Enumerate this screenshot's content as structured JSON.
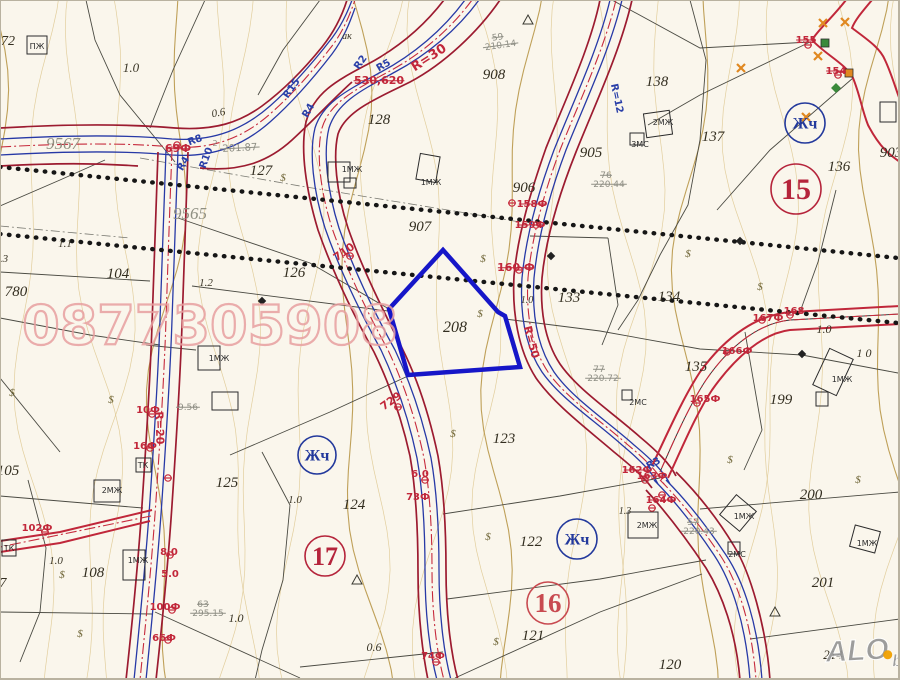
{
  "map": {
    "title": "cadastral-plan-scan",
    "colors": {
      "background": "#faf6ec",
      "road_red": "#9c1b30",
      "road_center_red": "#c62a3c",
      "line_blue": "#2739a6",
      "contour_light": "#dcc489",
      "contour_dark": "#b4903e",
      "parcel_line": "#4a4a42",
      "dotted_black": "#161616",
      "polygon_blue": "#1616c8",
      "watermark_pink": "#e8a0a0",
      "circle_red": "#b5243b",
      "circle_blue": "#23399c",
      "logo_gray": "#969696",
      "logo_orange": "#f0a000",
      "symbol_olive": "#6a6030",
      "marker_orange": "#e08820",
      "marker_green": "#3a8a3a"
    },
    "watermark": {
      "text": "0877305908",
      "x": 210,
      "y": 344,
      "size": 54
    },
    "logo": {
      "main": "ALO",
      "sub": "bg",
      "x": 826,
      "y": 662
    },
    "subject_parcel": {
      "number": "208",
      "points": "443,250 498,312 505,316 520,367 408,375 389,309"
    },
    "circled_labels": [
      {
        "t": "15",
        "x": 796,
        "y": 189,
        "r": 25,
        "c": "#b5243b",
        "fs": 30
      },
      {
        "t": "17",
        "x": 325,
        "y": 556,
        "r": 20,
        "c": "#b5243b",
        "fs": 26
      },
      {
        "t": "16",
        "x": 548,
        "y": 603,
        "r": 21,
        "c": "#c84a50",
        "fs": 27
      },
      {
        "t": "Жч",
        "x": 805,
        "y": 123,
        "r": 20,
        "c": "#23399c",
        "fs": 16
      },
      {
        "t": "Жч",
        "x": 317,
        "y": 455,
        "r": 19,
        "c": "#23399c",
        "fs": 16
      },
      {
        "t": "Жч",
        "x": 577,
        "y": 539,
        "r": 20,
        "c": "#23399c",
        "fs": 16
      }
    ],
    "labels": [
      {
        "t": "72",
        "x": 8,
        "y": 45,
        "c": "parcel",
        "s": 14
      },
      {
        "t": "127",
        "x": 261,
        "y": 175,
        "c": "parcel",
        "s": 15
      },
      {
        "t": "128",
        "x": 379,
        "y": 124,
        "c": "parcel",
        "s": 15
      },
      {
        "t": "908",
        "x": 494,
        "y": 79,
        "c": "parcel",
        "s": 15
      },
      {
        "t": "905",
        "x": 591,
        "y": 157,
        "c": "parcel",
        "s": 15
      },
      {
        "t": "906",
        "x": 524,
        "y": 192,
        "c": "parcel",
        "s": 15
      },
      {
        "t": "907",
        "x": 420,
        "y": 231,
        "c": "parcel",
        "s": 15
      },
      {
        "t": "903",
        "x": 891,
        "y": 157,
        "c": "parcel",
        "s": 15
      },
      {
        "t": "138",
        "x": 657,
        "y": 86,
        "c": "parcel",
        "s": 15
      },
      {
        "t": "137",
        "x": 713,
        "y": 141,
        "c": "parcel",
        "s": 15
      },
      {
        "t": "136",
        "x": 839,
        "y": 171,
        "c": "parcel",
        "s": 15
      },
      {
        "t": "104",
        "x": 118,
        "y": 278,
        "c": "parcel",
        "s": 15
      },
      {
        "t": "780",
        "x": 16,
        "y": 296,
        "c": "parcel",
        "s": 15
      },
      {
        "t": "126",
        "x": 294,
        "y": 277,
        "c": "parcel",
        "s": 15
      },
      {
        "t": "133",
        "x": 569,
        "y": 302,
        "c": "parcel",
        "s": 15
      },
      {
        "t": "134",
        "x": 669,
        "y": 301,
        "c": "parcel",
        "s": 15
      },
      {
        "t": "135",
        "x": 696,
        "y": 371,
        "c": "parcel",
        "s": 15
      },
      {
        "t": "199",
        "x": 781,
        "y": 404,
        "c": "parcel",
        "s": 15
      },
      {
        "t": "208",
        "x": 455,
        "y": 332,
        "c": "parcel",
        "s": 16
      },
      {
        "t": "123",
        "x": 504,
        "y": 443,
        "c": "parcel",
        "s": 15
      },
      {
        "t": "125",
        "x": 227,
        "y": 487,
        "c": "parcel",
        "s": 15
      },
      {
        "t": "124",
        "x": 354,
        "y": 509,
        "c": "parcel",
        "s": 15
      },
      {
        "t": "122",
        "x": 531,
        "y": 546,
        "c": "parcel",
        "s": 15
      },
      {
        "t": "121",
        "x": 533,
        "y": 640,
        "c": "parcel",
        "s": 15
      },
      {
        "t": "105",
        "x": 8,
        "y": 475,
        "c": "parcel",
        "s": 15
      },
      {
        "t": "108",
        "x": 93,
        "y": 577,
        "c": "parcel",
        "s": 15
      },
      {
        "t": "7",
        "x": 3,
        "y": 587,
        "c": "parcel",
        "s": 14
      },
      {
        "t": "120",
        "x": 670,
        "y": 669,
        "c": "parcel",
        "s": 15
      },
      {
        "t": "200",
        "x": 811,
        "y": 499,
        "c": "parcel",
        "s": 15
      },
      {
        "t": "201",
        "x": 823,
        "y": 587,
        "c": "parcel",
        "s": 15
      },
      {
        "t": "214",
        "x": 833,
        "y": 659,
        "c": "parcel",
        "s": 13
      },
      {
        "t": "9567",
        "x": 63,
        "y": 149,
        "c": "street",
        "s": 17
      },
      {
        "t": "9565",
        "x": 190,
        "y": 219,
        "c": "street",
        "s": 17
      },
      {
        "t": "1.0",
        "x": 131,
        "y": 72,
        "c": "small",
        "s": 13
      },
      {
        "t": "0.6",
        "x": 219,
        "y": 116,
        "c": "small",
        "s": 11,
        "r": -10
      },
      {
        "t": "ак",
        "x": 347,
        "y": 39,
        "c": "small",
        "s": 10
      },
      {
        "t": "1.1",
        "x": 65,
        "y": 247,
        "c": "small",
        "s": 11
      },
      {
        "t": ".3",
        "x": 4,
        "y": 262,
        "c": "small",
        "s": 11
      },
      {
        "t": "1.2",
        "x": 206,
        "y": 286,
        "c": "small",
        "s": 11
      },
      {
        "t": "1.0",
        "x": 527,
        "y": 303,
        "c": "small",
        "s": 10
      },
      {
        "t": "1.0",
        "x": 824,
        "y": 333,
        "c": "small",
        "s": 12
      },
      {
        "t": "1 0",
        "x": 864,
        "y": 357,
        "c": "small",
        "s": 12
      },
      {
        "t": "1.0",
        "x": 295,
        "y": 503,
        "c": "small",
        "s": 11
      },
      {
        "t": "1.0",
        "x": 56,
        "y": 564,
        "c": "small",
        "s": 11
      },
      {
        "t": "1.0",
        "x": 236,
        "y": 622,
        "c": "small",
        "s": 12
      },
      {
        "t": "0.6",
        "x": 374,
        "y": 651,
        "c": "small",
        "s": 12
      },
      {
        "t": "1.3",
        "x": 625,
        "y": 514,
        "c": "small",
        "s": 10
      },
      {
        "t": "2",
        "x": 215,
        "y": 146,
        "c": "gray",
        "s": 8
      },
      {
        "t": "201.87",
        "x": 240,
        "y": 151,
        "c": "gray",
        "s": 10,
        "r": -3,
        "k": 1
      },
      {
        "t": "59",
        "x": 498,
        "y": 40,
        "c": "gray",
        "s": 9,
        "r": -8,
        "k": 1
      },
      {
        "t": "210.14",
        "x": 501,
        "y": 48,
        "c": "gray",
        "s": 9,
        "r": -8,
        "k": 1
      },
      {
        "t": "76",
        "x": 606,
        "y": 178,
        "c": "gray",
        "s": 9,
        "k": 1
      },
      {
        "t": "220.44",
        "x": 609,
        "y": 187,
        "c": "gray",
        "s": 9,
        "k": 1
      },
      {
        "t": "77",
        "x": 599,
        "y": 372,
        "c": "gray",
        "s": 9,
        "k": 1
      },
      {
        "t": "220.72",
        "x": 603,
        "y": 381,
        "c": "gray",
        "s": 9,
        "k": 1
      },
      {
        "t": "63",
        "x": 203,
        "y": 607,
        "c": "gray",
        "s": 9,
        "k": 1
      },
      {
        "t": "295.15",
        "x": 208,
        "y": 616,
        "c": "gray",
        "s": 9,
        "k": 1
      },
      {
        "t": "57",
        "x": 693,
        "y": 525,
        "c": "gray",
        "s": 9,
        "k": 1
      },
      {
        "t": "220.43",
        "x": 699,
        "y": 534,
        "c": "gray",
        "s": 9,
        "k": 1
      },
      {
        "t": "9.56",
        "x": 188,
        "y": 410,
        "c": "gray",
        "s": 9,
        "k": 1
      },
      {
        "t": "69Ф",
        "x": 178,
        "y": 152,
        "c": "red",
        "s": 11,
        "k": 1
      },
      {
        "t": "530,620",
        "x": 379,
        "y": 84,
        "c": "red",
        "s": 11,
        "k": 1
      },
      {
        "t": "R=30",
        "x": 431,
        "y": 61,
        "c": "red",
        "s": 13,
        "r": -33
      },
      {
        "t": "710",
        "x": 346,
        "y": 255,
        "c": "red",
        "s": 11,
        "r": -35
      },
      {
        "t": "729",
        "x": 393,
        "y": 404,
        "c": "red",
        "s": 11,
        "r": -35
      },
      {
        "t": "160 Ф",
        "x": 516,
        "y": 271,
        "c": "red",
        "s": 11,
        "k": 1
      },
      {
        "t": "R=50",
        "x": 528,
        "y": 343,
        "c": "red",
        "s": 11,
        "r": 75
      },
      {
        "t": "R=20",
        "x": 156,
        "y": 428,
        "c": "red",
        "s": 11,
        "r": 88
      },
      {
        "t": "158Ф",
        "x": 532,
        "y": 207,
        "c": "red",
        "s": 10,
        "k": 1
      },
      {
        "t": "159Ф",
        "x": 530,
        "y": 228,
        "c": "red",
        "s": 10,
        "k": 1
      },
      {
        "t": "155",
        "x": 806,
        "y": 43,
        "c": "red",
        "s": 10,
        "k": 1
      },
      {
        "t": "154",
        "x": 836,
        "y": 74,
        "c": "red",
        "s": 10,
        "k": 1
      },
      {
        "t": "167Ф",
        "x": 768,
        "y": 321,
        "c": "red",
        "s": 10
      },
      {
        "t": "168",
        "x": 794,
        "y": 314,
        "c": "red",
        "s": 10
      },
      {
        "t": "166Ф",
        "x": 737,
        "y": 354,
        "c": "red",
        "s": 10
      },
      {
        "t": "165Ф",
        "x": 705,
        "y": 402,
        "c": "red",
        "s": 10
      },
      {
        "t": "162Ф",
        "x": 637,
        "y": 473,
        "c": "red",
        "s": 10,
        "k": 1
      },
      {
        "t": "163Ф",
        "x": 652,
        "y": 479,
        "c": "red",
        "s": 10,
        "k": 1
      },
      {
        "t": "164Ф",
        "x": 661,
        "y": 503,
        "c": "red",
        "s": 10,
        "k": 1
      },
      {
        "t": "6.0",
        "x": 420,
        "y": 477,
        "c": "red",
        "s": 10
      },
      {
        "t": "73Ф",
        "x": 418,
        "y": 500,
        "c": "red",
        "s": 10
      },
      {
        "t": "74Ф",
        "x": 433,
        "y": 659,
        "c": "red",
        "s": 10
      },
      {
        "t": "8.0",
        "x": 169,
        "y": 555,
        "c": "red",
        "s": 10
      },
      {
        "t": "5.0",
        "x": 170,
        "y": 577,
        "c": "red",
        "s": 10
      },
      {
        "t": "100Ф",
        "x": 165,
        "y": 610,
        "c": "red",
        "s": 10
      },
      {
        "t": "66Ф",
        "x": 164,
        "y": 641,
        "c": "red",
        "s": 10
      },
      {
        "t": "102Ф",
        "x": 37,
        "y": 531,
        "c": "red",
        "s": 10
      },
      {
        "t": "10Ф",
        "x": 148,
        "y": 413,
        "c": "red",
        "s": 10
      },
      {
        "t": "16Ф",
        "x": 145,
        "y": 449,
        "c": "red",
        "s": 10
      },
      {
        "t": "R8",
        "x": 196,
        "y": 143,
        "c": "blue",
        "s": 10,
        "r": -20
      },
      {
        "t": "R4",
        "x": 186,
        "y": 165,
        "c": "blue",
        "s": 10,
        "r": -60
      },
      {
        "t": "R10",
        "x": 209,
        "y": 159,
        "c": "blue",
        "s": 10,
        "r": -70
      },
      {
        "t": "R2",
        "x": 363,
        "y": 64,
        "c": "blue",
        "s": 10,
        "r": -55
      },
      {
        "t": "R5",
        "x": 385,
        "y": 68,
        "c": "blue",
        "s": 10,
        "r": -30
      },
      {
        "t": "R4",
        "x": 311,
        "y": 112,
        "c": "blue",
        "s": 10,
        "r": -60
      },
      {
        "t": "R15",
        "x": 294,
        "y": 90,
        "c": "blue",
        "s": 10,
        "r": -55
      },
      {
        "t": "R=12",
        "x": 614,
        "y": 99,
        "c": "blue",
        "s": 10,
        "r": 78
      },
      {
        "t": "R3",
        "x": 655,
        "y": 466,
        "c": "blue",
        "s": 10,
        "r": -30
      }
    ],
    "buildings": [
      {
        "x": 27,
        "y": 36,
        "w": 20,
        "h": 18,
        "label": "ПЖ",
        "lx": 37,
        "ly": 49
      },
      {
        "x": 328,
        "y": 162,
        "w": 22,
        "h": 20,
        "label": "1МЖ",
        "lx": 352,
        "ly": 172
      },
      {
        "x": 344,
        "y": 178,
        "w": 12,
        "h": 10
      },
      {
        "x": 418,
        "y": 155,
        "w": 20,
        "h": 26,
        "rot": 10,
        "label": "1МЖ",
        "lx": 431,
        "ly": 185
      },
      {
        "x": 645,
        "y": 112,
        "w": 26,
        "h": 24,
        "rot": -8,
        "label": "2МЖ",
        "lx": 663,
        "ly": 125
      },
      {
        "x": 630,
        "y": 133,
        "w": 14,
        "h": 12,
        "label": "3МС",
        "lx": 640,
        "ly": 147
      },
      {
        "x": 198,
        "y": 346,
        "w": 22,
        "h": 24,
        "label": "1МЖ",
        "lx": 219,
        "ly": 361
      },
      {
        "x": 212,
        "y": 392,
        "w": 26,
        "h": 18
      },
      {
        "x": 94,
        "y": 480,
        "w": 26,
        "h": 22,
        "label": "2МЖ",
        "lx": 112,
        "ly": 493
      },
      {
        "x": 123,
        "y": 550,
        "w": 22,
        "h": 30,
        "label": "1МЖ",
        "lx": 138,
        "ly": 563
      },
      {
        "x": 628,
        "y": 512,
        "w": 30,
        "h": 26,
        "label": "2МЖ",
        "lx": 647,
        "ly": 528
      },
      {
        "x": 725,
        "y": 500,
        "w": 26,
        "h": 26,
        "rot": 40,
        "label": "1МЖ",
        "lx": 744,
        "ly": 519
      },
      {
        "x": 728,
        "y": 542,
        "w": 12,
        "h": 12,
        "label": "2МС",
        "lx": 737,
        "ly": 557
      },
      {
        "x": 852,
        "y": 528,
        "w": 26,
        "h": 22,
        "rot": 15,
        "label": "1МЖ",
        "lx": 867,
        "ly": 546
      },
      {
        "x": 820,
        "y": 352,
        "w": 26,
        "h": 40,
        "rot": 25,
        "label": "1МЖ",
        "lx": 842,
        "ly": 382
      },
      {
        "x": 816,
        "y": 392,
        "w": 12,
        "h": 14
      },
      {
        "x": 880,
        "y": 102,
        "w": 16,
        "h": 20
      },
      {
        "x": 622,
        "y": 390,
        "w": 10,
        "h": 10,
        "label": "2МС",
        "lx": 638,
        "ly": 405
      },
      {
        "x": 136,
        "y": 458,
        "w": 15,
        "h": 14,
        "label": "ТК",
        "lx": 143,
        "ly": 468
      },
      {
        "x": 2,
        "y": 540,
        "w": 14,
        "h": 16,
        "label": "ТК",
        "lx": 9,
        "ly": 551
      }
    ],
    "symbols": {
      "dollar": [
        [
          283,
          181
        ],
        [
          483,
          262
        ],
        [
          480,
          317
        ],
        [
          453,
          437
        ],
        [
          62,
          578
        ],
        [
          80,
          637
        ],
        [
          688,
          257
        ],
        [
          760,
          290
        ],
        [
          488,
          540
        ],
        [
          496,
          645
        ],
        [
          730,
          463
        ],
        [
          858,
          483
        ],
        [
          111,
          403
        ],
        [
          12,
          396
        ]
      ],
      "triangle": [
        [
          528,
          20
        ],
        [
          357,
          580
        ],
        [
          775,
          612
        ]
      ],
      "orange_cross": [
        [
          823,
          23
        ],
        [
          845,
          22
        ],
        [
          818,
          56
        ],
        [
          806,
          117
        ],
        [
          741,
          68
        ]
      ],
      "green_square": [
        [
          825,
          43
        ]
      ],
      "orange_square": [
        [
          849,
          73
        ]
      ],
      "green_diamond": [
        [
          836,
          88
        ]
      ],
      "black_diamond": [
        [
          262,
          301
        ],
        [
          802,
          354
        ],
        [
          551,
          256
        ],
        [
          740,
          241
        ]
      ],
      "red_marker": [
        [
          168,
          478
        ],
        [
          177,
          145
        ],
        [
          512,
          203
        ],
        [
          536,
          225
        ],
        [
          697,
          403
        ],
        [
          727,
          352
        ],
        [
          762,
          320
        ],
        [
          790,
          315
        ],
        [
          645,
          480
        ],
        [
          662,
          495
        ],
        [
          652,
          508
        ],
        [
          519,
          270
        ],
        [
          350,
          256
        ],
        [
          398,
          407
        ],
        [
          425,
          480
        ],
        [
          170,
          555
        ],
        [
          172,
          610
        ],
        [
          168,
          640
        ],
        [
          45,
          532
        ],
        [
          436,
          662
        ],
        [
          152,
          414
        ],
        [
          150,
          448
        ],
        [
          808,
          45
        ],
        [
          838,
          75
        ]
      ]
    }
  }
}
